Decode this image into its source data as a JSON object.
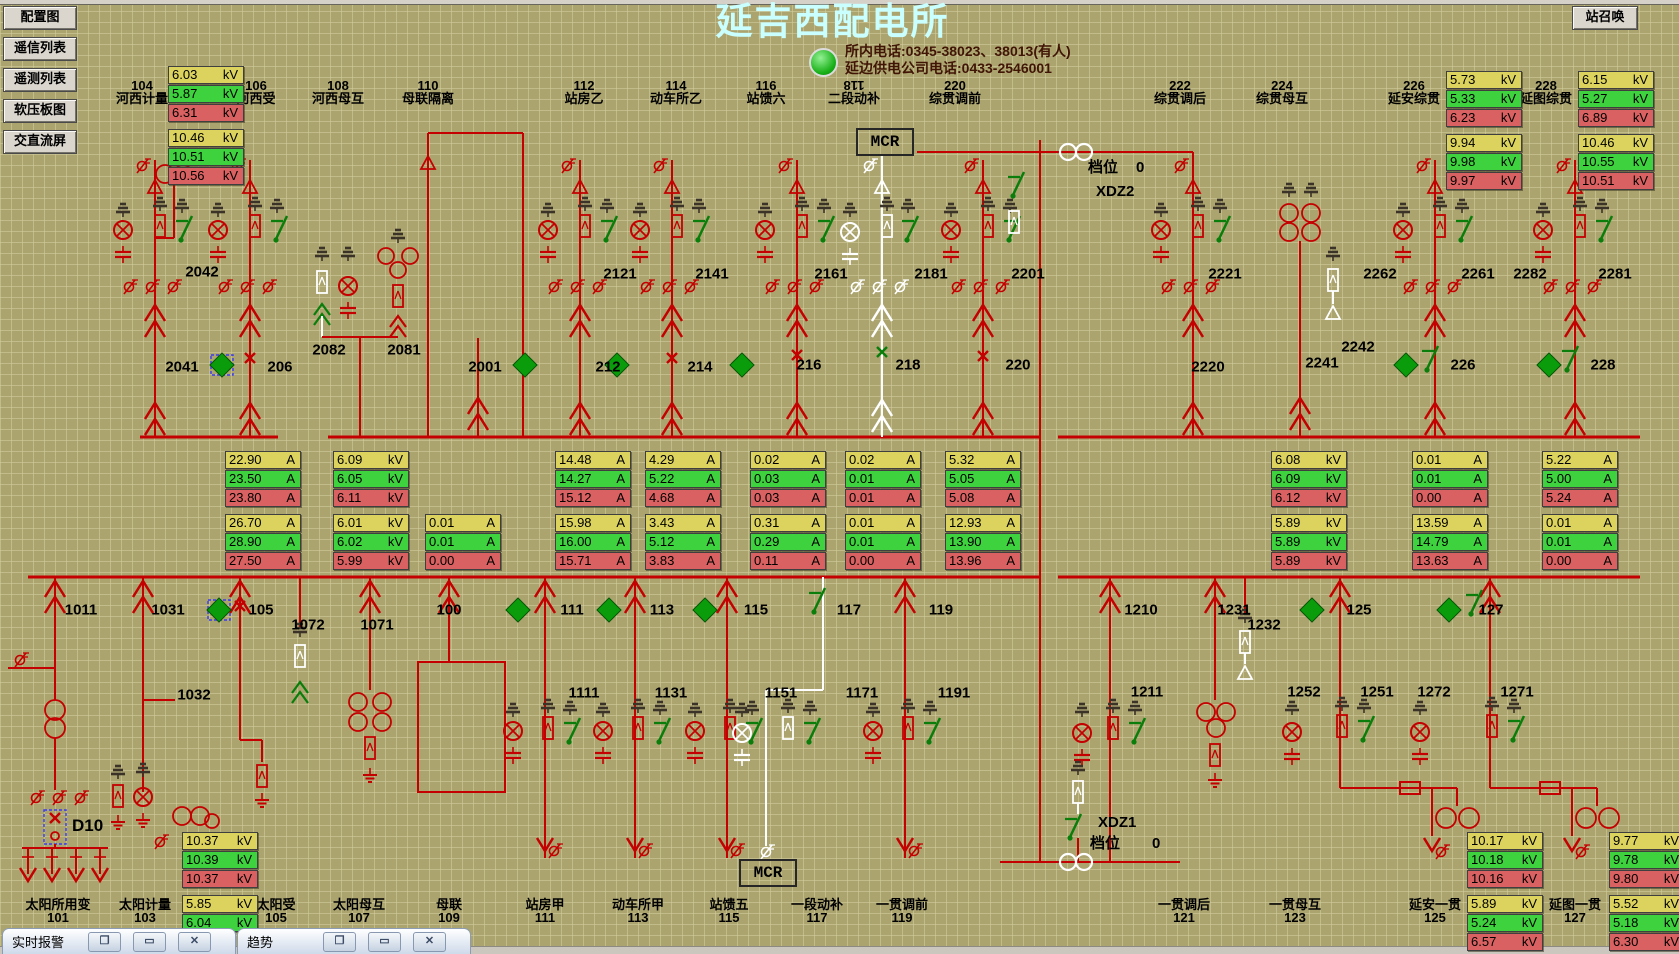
{
  "header": {
    "title": "延吉西配电所",
    "phone1": "所内电话:0345-38023、38013(有人)",
    "phone2": "延边供电公司电话:0433-2546001",
    "station_call": "站召唤"
  },
  "sidebar": {
    "buttons": [
      "配置图",
      "遥信列表",
      "遥测列表",
      "软压板图",
      "交直流屏"
    ]
  },
  "colors": {
    "accent_red": "#c40000",
    "meter_yellow": "#dcd35e",
    "meter_green": "#3ed23e",
    "meter_red": "#da6161",
    "title_cyan": "#caffff",
    "switch_green": "#0a7d0a"
  },
  "top_bays": [
    {
      "id": "104",
      "name": "河西计量",
      "cx": 142
    },
    {
      "id": "106",
      "name": "河西受",
      "cx": 256
    },
    {
      "id": "108",
      "name": "河西母互",
      "cx": 338
    },
    {
      "id": "110",
      "name": "母联隔离",
      "cx": 428
    },
    {
      "id": "112",
      "name": "站房乙",
      "cx": 584
    },
    {
      "id": "114",
      "name": "动车所乙",
      "cx": 676
    },
    {
      "id": "116",
      "name": "站馈六",
      "cx": 766
    },
    {
      "id": "118",
      "name": "二段动补",
      "cx": 854,
      "rotated": true
    },
    {
      "id": "220",
      "name": "综贯调前",
      "cx": 955
    },
    {
      "id": "222",
      "name": "综贯调后",
      "cx": 1180
    },
    {
      "id": "224",
      "name": "综贯母互",
      "cx": 1282
    },
    {
      "id": "226",
      "name": "延安综贯",
      "cx": 1414
    },
    {
      "id": "228",
      "name": "延图综贯",
      "cx": 1546
    }
  ],
  "bottom_bays": [
    {
      "name": "太阳所用变",
      "id": "101",
      "cx": 58
    },
    {
      "name": "太阳计量",
      "id": "103",
      "cx": 145
    },
    {
      "name": "太阳受",
      "id": "105",
      "cx": 276
    },
    {
      "name": "太阳母互",
      "id": "107",
      "cx": 359
    },
    {
      "name": "母联",
      "id": "109",
      "cx": 449
    },
    {
      "name": "站房甲",
      "id": "111",
      "cx": 545
    },
    {
      "name": "动车所甲",
      "id": "113",
      "cx": 638
    },
    {
      "name": "站馈五",
      "id": "115",
      "cx": 729
    },
    {
      "name": "一段动补",
      "id": "117",
      "cx": 817
    },
    {
      "name": "一贯调前",
      "id": "119",
      "cx": 902
    },
    {
      "name": "一贯调后",
      "id": "121",
      "cx": 1184
    },
    {
      "name": "一贯母互",
      "id": "123",
      "cx": 1295
    },
    {
      "name": "延安一贯",
      "id": "125",
      "cx": 1435
    },
    {
      "name": "延图一贯",
      "id": "127",
      "cx": 1575
    }
  ],
  "meters": [
    {
      "x": 168,
      "y": 66,
      "unit": "kV",
      "gap": 3,
      "rows": [
        "6.03",
        "5.87",
        "6.31",
        "10.46",
        "10.51",
        "10.56"
      ]
    },
    {
      "x": 1446,
      "y": 71,
      "unit": "kV",
      "gap": 3,
      "rows": [
        "5.73",
        "5.33",
        "6.23",
        "9.94",
        "9.98",
        "9.97"
      ]
    },
    {
      "x": 1578,
      "y": 71,
      "unit": "kV",
      "gap": 3,
      "rows": [
        "6.15",
        "5.27",
        "6.89",
        "10.46",
        "10.55",
        "10.51"
      ]
    },
    {
      "x": 225,
      "y": 451,
      "unit": "A",
      "gap": 3,
      "rows": [
        "22.90",
        "23.50",
        "23.80",
        "26.70",
        "28.90",
        "27.50"
      ]
    },
    {
      "x": 333,
      "y": 451,
      "unit": "kV",
      "gap": 3,
      "rows": [
        "6.09",
        "6.05",
        "6.11",
        "6.01",
        "6.02",
        "5.99"
      ]
    },
    {
      "x": 425,
      "y": 514,
      "unit": "A",
      "gap": 0,
      "rows": [
        "0.01",
        "0.01",
        "0.00"
      ]
    },
    {
      "x": 555,
      "y": 451,
      "unit": "A",
      "gap": 3,
      "rows": [
        "14.48",
        "14.27",
        "15.12",
        "15.98",
        "16.00",
        "15.71"
      ]
    },
    {
      "x": 645,
      "y": 451,
      "unit": "A",
      "gap": 3,
      "rows": [
        "4.29",
        "5.22",
        "4.68",
        "3.43",
        "5.12",
        "3.83"
      ]
    },
    {
      "x": 750,
      "y": 451,
      "unit": "A",
      "gap": 3,
      "rows": [
        "0.02",
        "0.03",
        "0.03",
        "0.31",
        "0.29",
        "0.11"
      ]
    },
    {
      "x": 845,
      "y": 451,
      "unit": "A",
      "gap": 3,
      "rows": [
        "0.02",
        "0.01",
        "0.01",
        "0.01",
        "0.01",
        "0.00"
      ]
    },
    {
      "x": 945,
      "y": 451,
      "unit": "A",
      "gap": 3,
      "rows": [
        "5.32",
        "5.05",
        "5.08",
        "12.93",
        "13.90",
        "13.96"
      ]
    },
    {
      "x": 1271,
      "y": 451,
      "unit": "kV",
      "gap": 3,
      "rows": [
        "6.08",
        "6.09",
        "6.12",
        "5.89",
        "5.89",
        "5.89"
      ]
    },
    {
      "x": 1412,
      "y": 451,
      "unit": "A",
      "gap": 3,
      "rows": [
        "0.01",
        "0.01",
        "0.00",
        "13.59",
        "14.79",
        "13.63"
      ]
    },
    {
      "x": 1542,
      "y": 451,
      "unit": "A",
      "gap": 3,
      "rows": [
        "5.22",
        "5.00",
        "5.24",
        "0.01",
        "0.01",
        "0.00"
      ]
    },
    {
      "x": 182,
      "y": 832,
      "unit": "kV",
      "gap": 3,
      "rows": [
        "10.37",
        "10.39",
        "10.37",
        "5.85",
        "6.04"
      ]
    },
    {
      "x": 1467,
      "y": 832,
      "unit": "kV",
      "gap": 3,
      "rows": [
        "10.17",
        "10.18",
        "10.16",
        "5.89",
        "5.24",
        "6.57"
      ]
    },
    {
      "x": 1609,
      "y": 832,
      "unit": "kV",
      "gap": 3,
      "rows": [
        "9.77",
        "9.78",
        "9.80",
        "5.52",
        "5.18",
        "6.30"
      ]
    }
  ],
  "switch_labels": [
    {
      "t": "2042",
      "cx": 202,
      "cy": 272
    },
    {
      "t": "2041",
      "cx": 182,
      "cy": 367
    },
    {
      "t": "206",
      "cx": 280,
      "cy": 367
    },
    {
      "t": "2082",
      "cx": 329,
      "cy": 350
    },
    {
      "t": "2081",
      "cx": 404,
      "cy": 350
    },
    {
      "t": "2001",
      "cx": 485,
      "cy": 367
    },
    {
      "t": "2121",
      "cx": 620,
      "cy": 274
    },
    {
      "t": "212",
      "cx": 608,
      "cy": 367
    },
    {
      "t": "2141",
      "cx": 712,
      "cy": 274
    },
    {
      "t": "214",
      "cx": 700,
      "cy": 367
    },
    {
      "t": "2161",
      "cx": 831,
      "cy": 274
    },
    {
      "t": "216",
      "cx": 809,
      "cy": 365
    },
    {
      "t": "2181",
      "cx": 931,
      "cy": 274
    },
    {
      "t": "218",
      "cx": 908,
      "cy": 365
    },
    {
      "t": "2201",
      "cx": 1028,
      "cy": 274
    },
    {
      "t": "220",
      "cx": 1018,
      "cy": 365
    },
    {
      "t": "2221",
      "cx": 1225,
      "cy": 274
    },
    {
      "t": "2220",
      "cx": 1208,
      "cy": 367
    },
    {
      "t": "2241",
      "cx": 1322,
      "cy": 363
    },
    {
      "t": "2242",
      "cx": 1358,
      "cy": 347
    },
    {
      "t": "2262",
      "cx": 1380,
      "cy": 274
    },
    {
      "t": "2261",
      "cx": 1478,
      "cy": 274
    },
    {
      "t": "226",
      "cx": 1463,
      "cy": 365
    },
    {
      "t": "2282",
      "cx": 1530,
      "cy": 274
    },
    {
      "t": "2281",
      "cx": 1615,
      "cy": 274
    },
    {
      "t": "228",
      "cx": 1603,
      "cy": 365
    },
    {
      "t": "1011",
      "cx": 81,
      "cy": 610
    },
    {
      "t": "1031",
      "cx": 168,
      "cy": 610
    },
    {
      "t": "105",
      "cx": 261,
      "cy": 610
    },
    {
      "t": "1072",
      "cx": 308,
      "cy": 625
    },
    {
      "t": "1071",
      "cx": 377,
      "cy": 625
    },
    {
      "t": "100",
      "cx": 449,
      "cy": 610
    },
    {
      "t": "111",
      "cx": 572,
      "cy": 610
    },
    {
      "t": "113",
      "cx": 662,
      "cy": 610
    },
    {
      "t": "115",
      "cx": 756,
      "cy": 610
    },
    {
      "t": "117",
      "cx": 849,
      "cy": 610
    },
    {
      "t": "119",
      "cx": 941,
      "cy": 610
    },
    {
      "t": "1210",
      "cx": 1141,
      "cy": 610
    },
    {
      "t": "1231",
      "cx": 1234,
      "cy": 610
    },
    {
      "t": "1232",
      "cx": 1264,
      "cy": 625
    },
    {
      "t": "125",
      "cx": 1359,
      "cy": 610
    },
    {
      "t": "127",
      "cx": 1491,
      "cy": 610
    },
    {
      "t": "1032",
      "cx": 194,
      "cy": 695
    },
    {
      "t": "1111",
      "cx": 584,
      "cy": 693
    },
    {
      "t": "1131",
      "cx": 671,
      "cy": 693
    },
    {
      "t": "1151",
      "cx": 781,
      "cy": 693
    },
    {
      "t": "1171",
      "cx": 862,
      "cy": 693
    },
    {
      "t": "1191",
      "cx": 954,
      "cy": 693
    },
    {
      "t": "1211",
      "cx": 1147,
      "cy": 692
    },
    {
      "t": "1252",
      "cx": 1304,
      "cy": 692
    },
    {
      "t": "1251",
      "cx": 1377,
      "cy": 692
    },
    {
      "t": "1272",
      "cx": 1434,
      "cy": 692
    },
    {
      "t": "1271",
      "cx": 1517,
      "cy": 692
    }
  ],
  "mcr_top": "MCR",
  "mcr_bottom": "MCR",
  "xdz_top": {
    "tap": "档位",
    "tap_value": "0",
    "name": "XDZ2"
  },
  "xdz_bottom": {
    "name": "XDZ1",
    "tap": "档位",
    "tap_value": "0"
  },
  "d10": "D10",
  "taskbar": {
    "windows": [
      "实时报警",
      "趋势"
    ]
  }
}
